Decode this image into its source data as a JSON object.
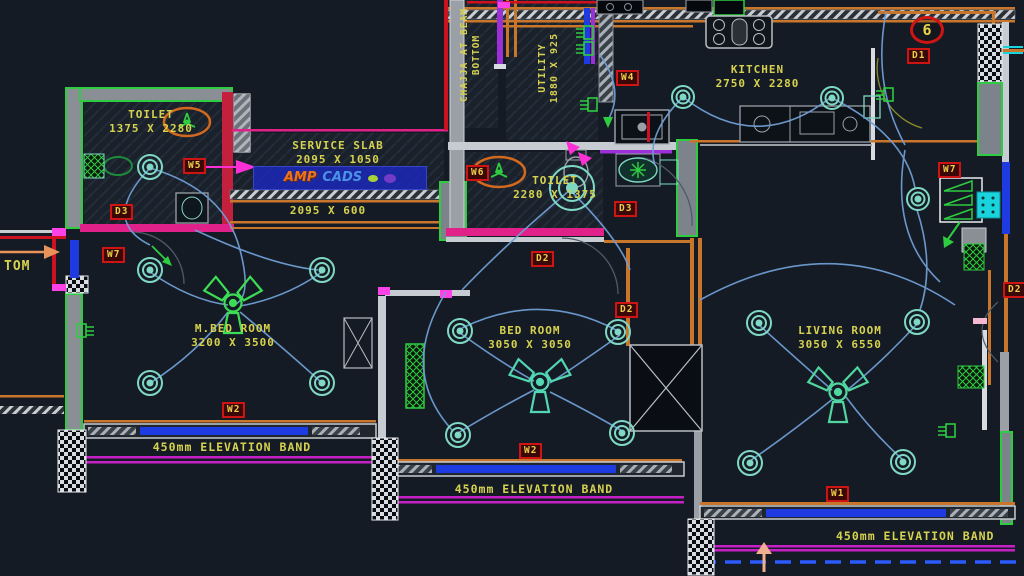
{
  "drawing": {
    "type": "electrical layout floor plan",
    "background_color": "#151b24",
    "text_color": "#d6d24f",
    "tag_border_color": "#cf1414",
    "wall_green": "#2ecc40",
    "wall_orange": "#c8762c",
    "wall_magenta": "#e0218a",
    "window_blue": "#1d3be0",
    "wire_blue": "#6f9ed4",
    "fixture_teal": "#7fd8c4"
  },
  "rooms": {
    "toilet_1": {
      "name": "TOILET",
      "dims": "1375 X 2280"
    },
    "service_slab": {
      "name": "SERVICE SLAB",
      "dims": "2095 X 1050"
    },
    "service_band": {
      "dims": "2095 X 600"
    },
    "kitchen": {
      "name": "KITCHEN",
      "dims": "2750 X 2280"
    },
    "utility": {
      "name": "UTILITY",
      "dims": "1880 X 925"
    },
    "toilet_2": {
      "name": "TOILET",
      "dims": "2280 X 1375"
    },
    "m_bed_room": {
      "name": "M.BED ROOM",
      "dims": "3200 X 3500"
    },
    "bed_room": {
      "name": "BED ROOM",
      "dims": "3050 X 3050"
    },
    "living_room": {
      "name": "LIVING ROOM",
      "dims": "3050 X 6550"
    }
  },
  "annotations": {
    "chajja_line1": "CHAJJA AT BEAM",
    "chajja_line2": "BOTTOM",
    "elevation_band": "450mm ELEVATION BAND",
    "left_edge_text": "TOM"
  },
  "tags": {
    "w5": "W5",
    "w7_left": "W7",
    "w7_right": "W7",
    "w6": "W6",
    "w4": "W4",
    "w2_a": "W2",
    "w2_b": "W2",
    "w1": "W1",
    "d3_a": "D3",
    "d3_b": "D3",
    "d2_a": "D2",
    "d2_b": "D2",
    "d2_c": "D2",
    "d1": "D1",
    "door_number": "6"
  },
  "watermark": {
    "part1": "AMP",
    "part2": "CADS"
  },
  "icons": {
    "ceiling_fan": "3-blade ceiling fan symbol",
    "ceiling_light": "concentric circle light point",
    "exhaust_fan": "orange round exhaust fan",
    "switch_socket": "3-prong switch socket symbol"
  }
}
